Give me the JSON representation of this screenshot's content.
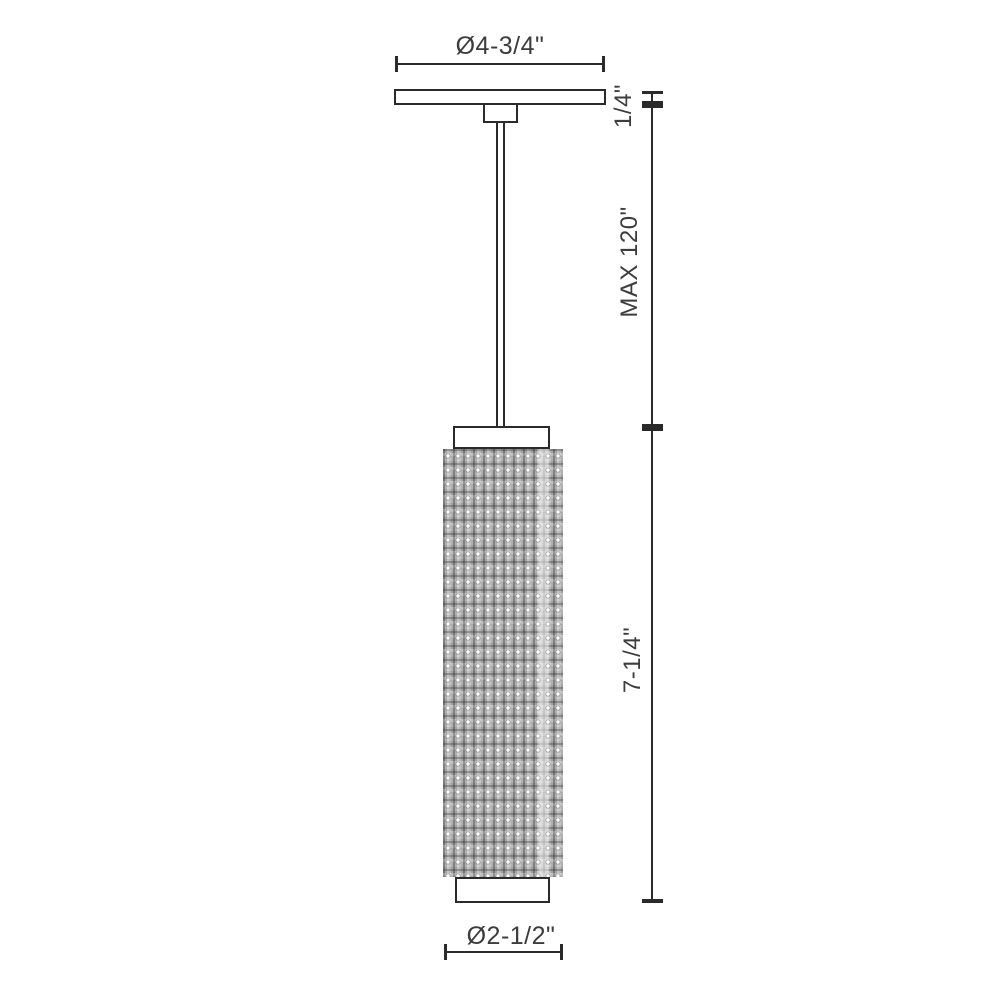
{
  "drawing": {
    "type": "pendant light fixture dimension drawing",
    "dimensions": {
      "canopy_diameter": "Ø4-3/4\"",
      "canopy_thickness": "1/4\"",
      "rod_max_length": "MAX 120\"",
      "shade_height": "7-1/4\"",
      "shade_diameter": "Ø2-1/2\""
    },
    "colors": {
      "line": "#2a2a2a",
      "text": "#3c3c3c",
      "background": "#ffffff",
      "shade_base_gray": "#d8d8d8",
      "shade_stripe_gray": "#8f8f8f"
    }
  }
}
